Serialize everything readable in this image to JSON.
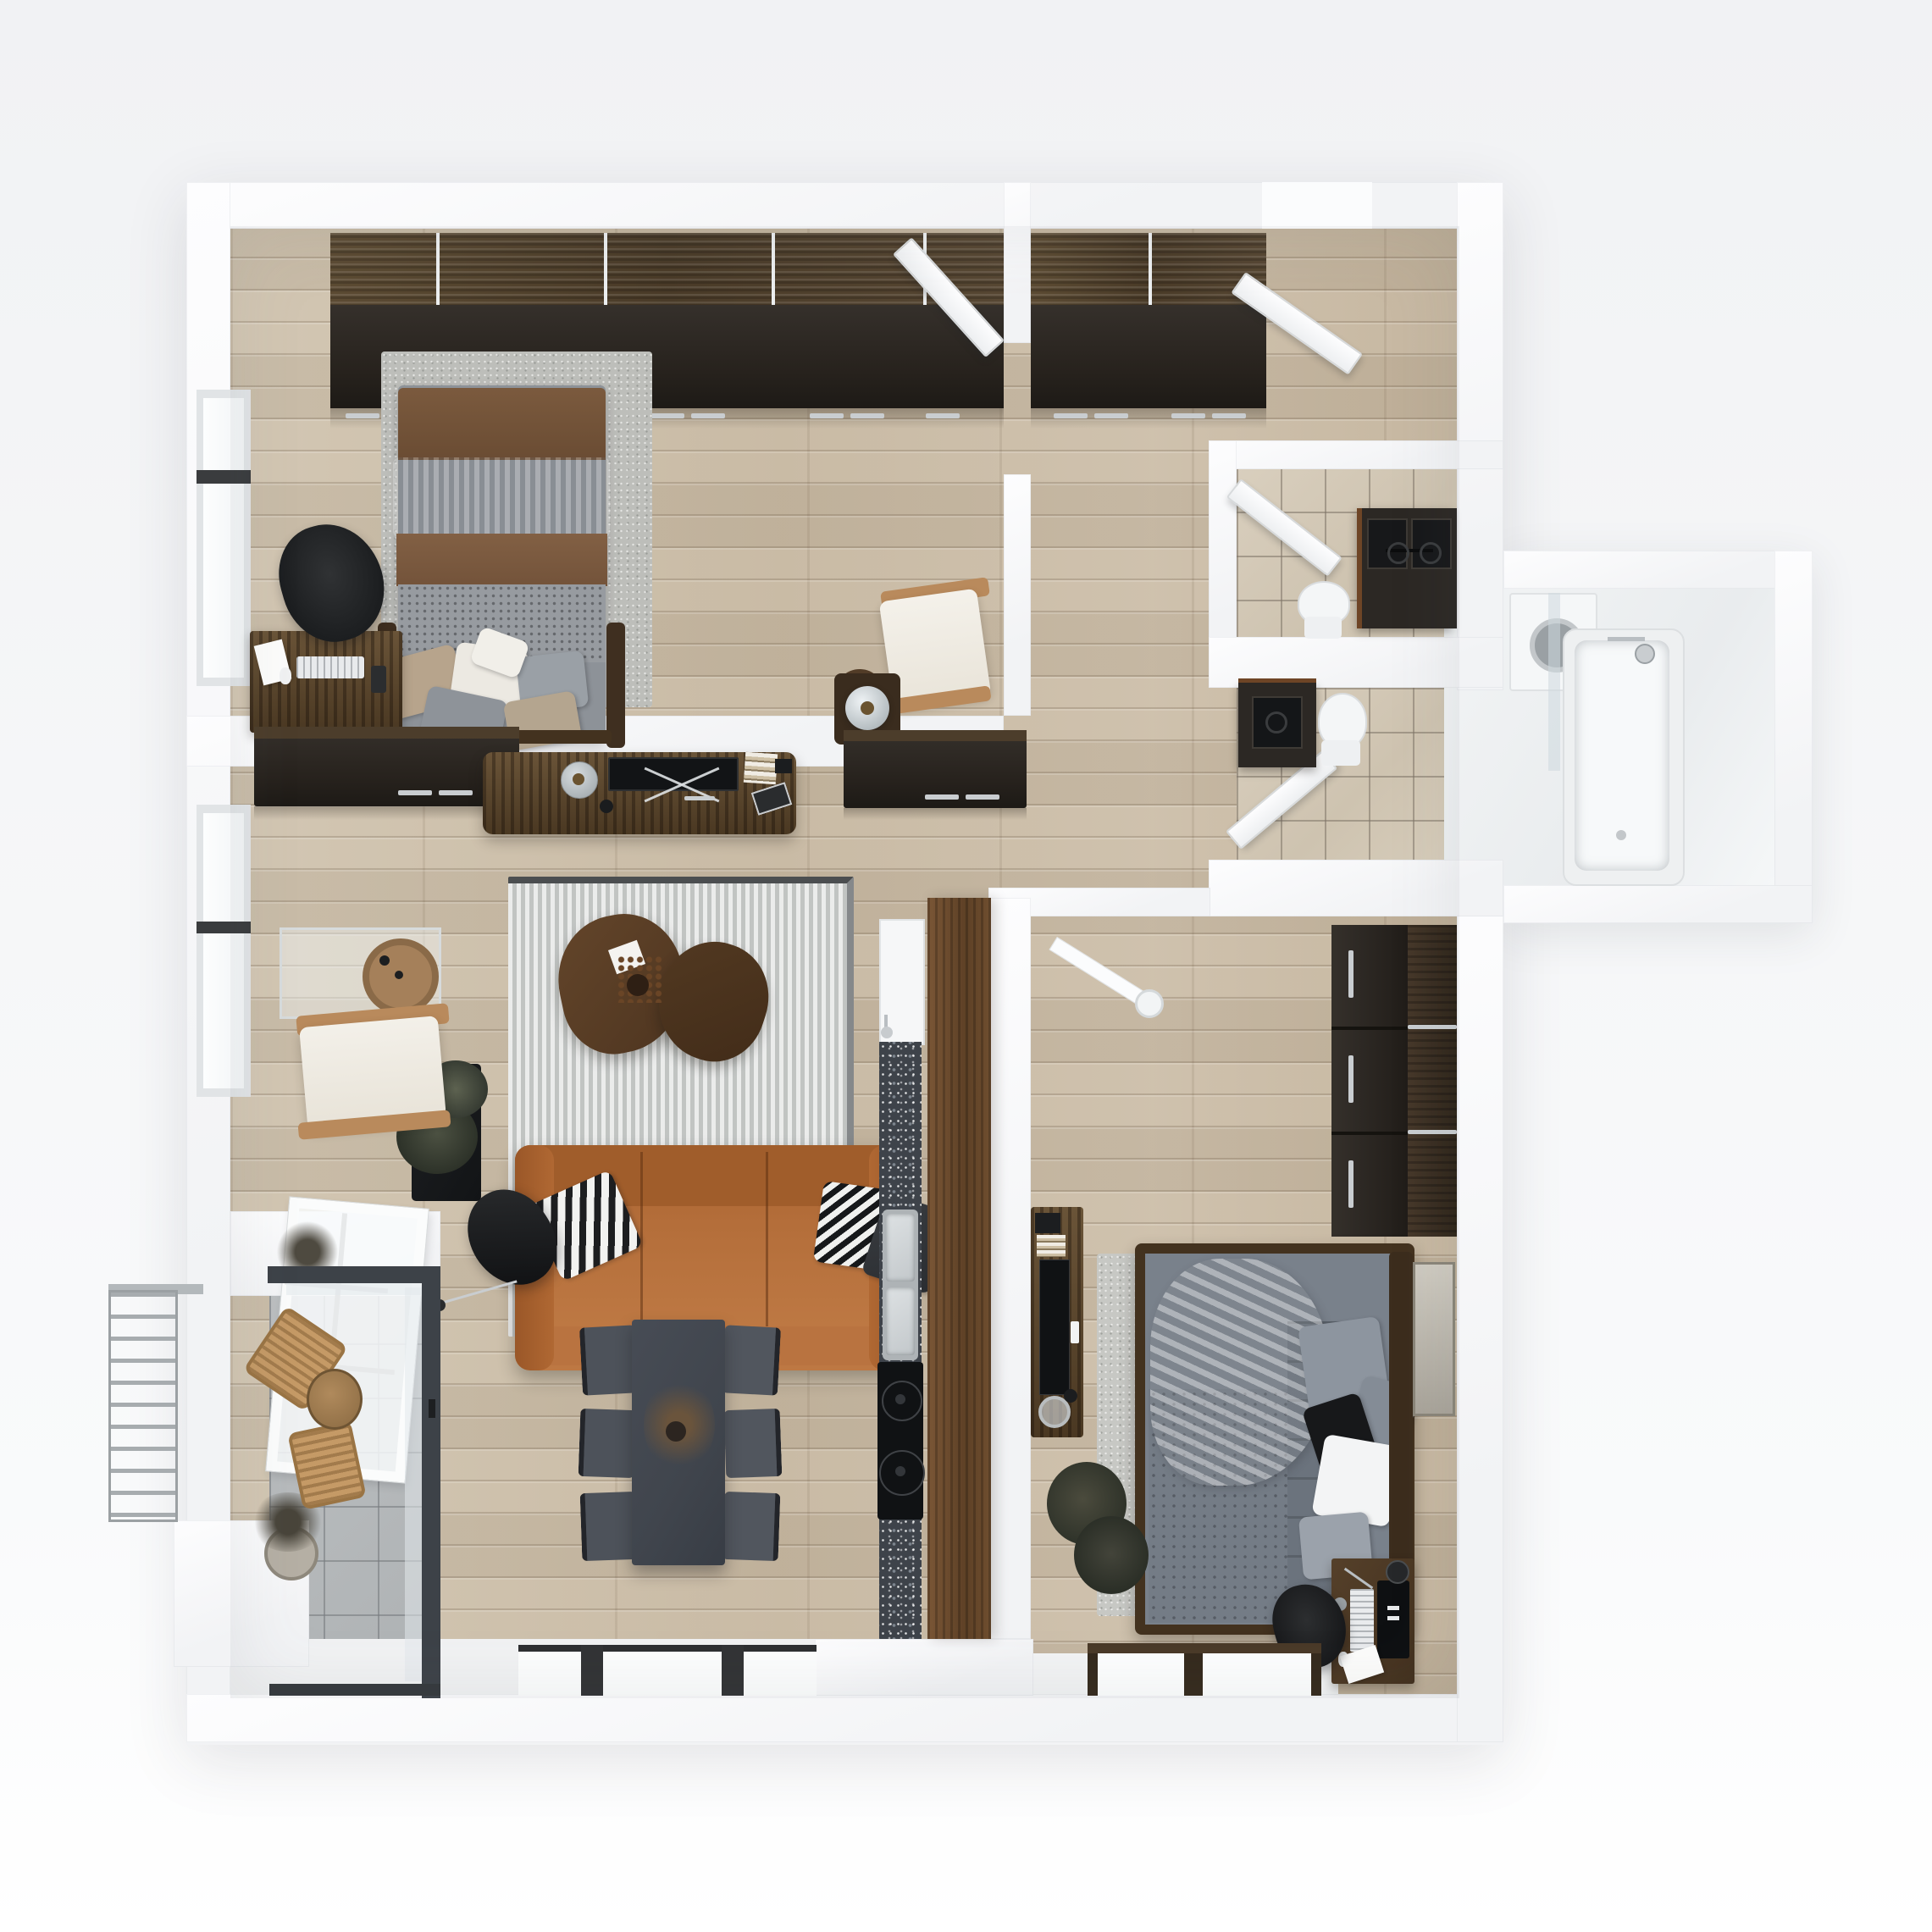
{
  "scene": {
    "type": "3d-floor-plan-top-down-render",
    "style": "photoreal apartment visualization",
    "text_visible": "none"
  },
  "palette": {
    "bg1": "#f1f2f4",
    "bg2": "#f9fafb",
    "wall": "#f2f3f5",
    "floor": "#c9bba5",
    "wardwood": "#53432e",
    "wardfront": "#27221d",
    "tileb": "#d3c8b6",
    "tileg": "#b5b8ba",
    "walnut": "#6d4c2f",
    "granite": "#3e434a",
    "sofa": "#b46e3a",
    "rug": "#d2d4d3",
    "dining": "#40454d",
    "duvet": "#79818b",
    "metal": "#c9cdd0",
    "frame_dark": "#3d4248"
  },
  "rooms": [
    {
      "id": "bedroom-1",
      "location": "top-left",
      "furniture": [
        "wardrobe-wood-band",
        "wardrobe-dark-front",
        "double-bed-brown-gray",
        "area-rug",
        "desk",
        "keyboard",
        "desk-chair",
        "lounge-chair",
        "stump-table",
        "nightstand-glass-lamp",
        "window"
      ]
    },
    {
      "id": "entry-hall",
      "location": "top-right",
      "furniture": [
        "wardrobe",
        "entry-door-open",
        "bedroom-door-open"
      ]
    },
    {
      "id": "wc",
      "location": "right",
      "furniture": [
        "double-vanity-dark",
        "toilet",
        "door-open"
      ]
    },
    {
      "id": "bathroom",
      "location": "right-wing",
      "furniture": [
        "vanity-dark",
        "toilet",
        "washing-machine",
        "bathtub",
        "shower-fixture",
        "glass-screen",
        "door-open"
      ]
    },
    {
      "id": "living-room",
      "location": "center-left",
      "furniture": [
        "wall-cabinet-left",
        "tv-console",
        "tv-flat",
        "candle-dome",
        "x-frame",
        "books",
        "magazine",
        "wall-cabinet-right",
        "striped-rug",
        "coffee-table-pair",
        "leather-sofa",
        "pillow-striped",
        "pillow-chevron",
        "pillow-dark",
        "floor-lamp-cone",
        "planter",
        "armchair-cream",
        "glass-console-table",
        "leaning-frame",
        "window",
        "ledge-plants"
      ]
    },
    {
      "id": "kitchen-strip",
      "location": "center",
      "furniture": [
        "tall-white-cabinet",
        "granite-counter",
        "double-sink",
        "faucet",
        "cooktop",
        "walnut-partition"
      ]
    },
    {
      "id": "dining-area",
      "location": "bottom-center",
      "furniture": [
        "dining-table",
        "dining-chairs-x6",
        "dried-centerpiece",
        "windows"
      ]
    },
    {
      "id": "bedroom-2",
      "location": "bottom-right",
      "furniture": [
        "ceiling-lamp",
        "wardrobe-drawers",
        "bed-gray",
        "crumpled-blanket",
        "pillows",
        "area-rug",
        "media-bench",
        "tv-flat",
        "remote",
        "candles",
        "plant",
        "artwork",
        "desk",
        "monitor",
        "keyboard",
        "desk-chair",
        "windows"
      ]
    },
    {
      "id": "balcony",
      "location": "bottom-left",
      "furniture": [
        "glazing-frame",
        "rattan-chair-1",
        "rattan-chair-2",
        "round-table",
        "exterior-railing"
      ]
    }
  ]
}
